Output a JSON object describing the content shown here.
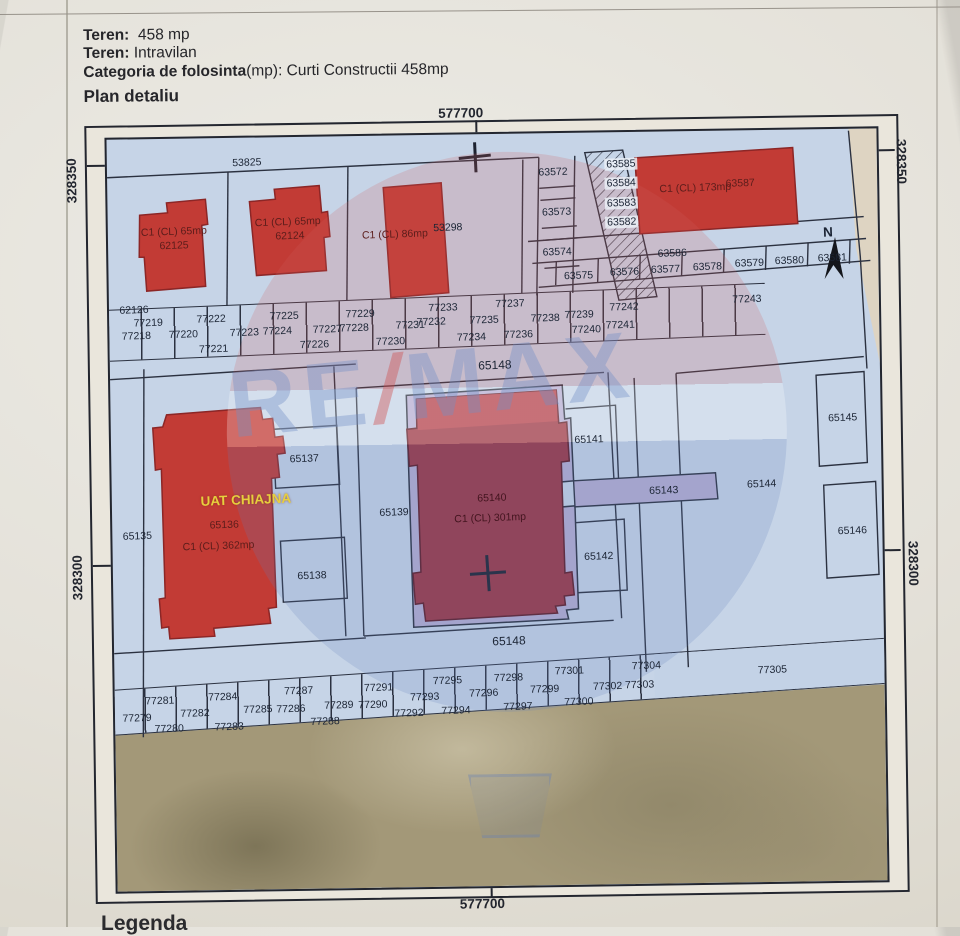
{
  "header": {
    "teren_label": "Teren:",
    "teren_value": "458 mp",
    "teren2_label": "Teren:",
    "teren2_value": "Intravilan",
    "categoria_label": "Categoria de folosinta",
    "categoria_value": "(mp): Curti Constructii 458mp",
    "plan_title": "Plan detaliu",
    "legend_partial": "Legenda"
  },
  "coords": {
    "top": "577700",
    "bottom": "577700",
    "left_top": "328350",
    "left_bottom": "328300",
    "right_top": "328350",
    "right_bottom": "328300"
  },
  "watermark": {
    "re": "RE",
    "slash": "/",
    "max": "MAX"
  },
  "colors": {
    "building_red": "#c23b35",
    "building_maroon": "#9c3744",
    "map_blue": "#c6d4e7",
    "lot_lavender": "#b5aed2",
    "uat_yellow": "#e7cf3d",
    "terrain_tan": "#a39878",
    "line": "#2b3140"
  },
  "map": {
    "parcel_labels": [
      {
        "t": "53825",
        "x": 140,
        "y": 25
      },
      {
        "t": "C1 (CL) 65mp",
        "x": 66,
        "y": 93,
        "c": "bld"
      },
      {
        "t": "62125",
        "x": 66,
        "y": 107,
        "c": "bld"
      },
      {
        "t": "C1 (CL) 65mp",
        "x": 180,
        "y": 85,
        "c": "bld"
      },
      {
        "t": "62124",
        "x": 182,
        "y": 99,
        "c": "bld"
      },
      {
        "t": "C1 (CL) 86mp",
        "x": 287,
        "y": 99,
        "c": "bld"
      },
      {
        "t": "53298",
        "x": 340,
        "y": 93
      },
      {
        "t": "62126",
        "x": 25,
        "y": 171
      },
      {
        "t": "63572",
        "x": 446,
        "y": 39
      },
      {
        "t": "63573",
        "x": 449,
        "y": 79
      },
      {
        "t": "63574",
        "x": 449,
        "y": 119
      },
      {
        "t": "63585",
        "x": 514,
        "y": 32,
        "c": "chip"
      },
      {
        "t": "63584",
        "x": 514,
        "y": 51,
        "c": "chip"
      },
      {
        "t": "63583",
        "x": 514,
        "y": 71,
        "c": "chip"
      },
      {
        "t": "63582",
        "x": 514,
        "y": 90,
        "c": "chip"
      },
      {
        "t": "C1 (CL) 173mp",
        "x": 588,
        "y": 57,
        "c": "bld"
      },
      {
        "t": "63587",
        "x": 633,
        "y": 53,
        "c": "bld"
      },
      {
        "t": "63586",
        "x": 564,
        "y": 122
      },
      {
        "t": "63575",
        "x": 470,
        "y": 143
      },
      {
        "t": "63576",
        "x": 516,
        "y": 140
      },
      {
        "t": "63577",
        "x": 557,
        "y": 138
      },
      {
        "t": "63578",
        "x": 599,
        "y": 136
      },
      {
        "t": "63579",
        "x": 641,
        "y": 133
      },
      {
        "t": "63580",
        "x": 681,
        "y": 131
      },
      {
        "t": "63581",
        "x": 724,
        "y": 129
      },
      {
        "t": "N",
        "x": 720,
        "y": 103,
        "c": "north"
      },
      {
        "t": "77243",
        "x": 638,
        "y": 169
      },
      {
        "t": "77218",
        "x": 27,
        "y": 197
      },
      {
        "t": "77219",
        "x": 39,
        "y": 184
      },
      {
        "t": "77220",
        "x": 74,
        "y": 196
      },
      {
        "t": "77221",
        "x": 104,
        "y": 211
      },
      {
        "t": "77222",
        "x": 102,
        "y": 181
      },
      {
        "t": "77223",
        "x": 135,
        "y": 195
      },
      {
        "t": "77224",
        "x": 168,
        "y": 194
      },
      {
        "t": "77225",
        "x": 175,
        "y": 179
      },
      {
        "t": "77226",
        "x": 205,
        "y": 208
      },
      {
        "t": "77227",
        "x": 218,
        "y": 193
      },
      {
        "t": "77228",
        "x": 245,
        "y": 192
      },
      {
        "t": "77229",
        "x": 251,
        "y": 178
      },
      {
        "t": "77230",
        "x": 281,
        "y": 206
      },
      {
        "t": "77231",
        "x": 301,
        "y": 190
      },
      {
        "t": "77232",
        "x": 322,
        "y": 187
      },
      {
        "t": "77233",
        "x": 334,
        "y": 173
      },
      {
        "t": "77234",
        "x": 362,
        "y": 203
      },
      {
        "t": "77235",
        "x": 375,
        "y": 186
      },
      {
        "t": "77236",
        "x": 409,
        "y": 201
      },
      {
        "t": "77237",
        "x": 401,
        "y": 170
      },
      {
        "t": "77238",
        "x": 436,
        "y": 185
      },
      {
        "t": "77239",
        "x": 470,
        "y": 182
      },
      {
        "t": "77240",
        "x": 477,
        "y": 197
      },
      {
        "t": "77241",
        "x": 511,
        "y": 193
      },
      {
        "t": "77242",
        "x": 515,
        "y": 175
      },
      {
        "t": "65148",
        "x": 385,
        "y": 231,
        "c": "road"
      },
      {
        "t": "65135",
        "x": 25,
        "y": 397
      },
      {
        "t": "UAT CHIAJNA",
        "x": 134,
        "y": 362,
        "c": "uat"
      },
      {
        "t": "65136",
        "x": 112,
        "y": 387,
        "c": "bld"
      },
      {
        "t": "C1 (CL) 362mp",
        "x": 106,
        "y": 408,
        "c": "bld"
      },
      {
        "t": "65137",
        "x": 193,
        "y": 322
      },
      {
        "t": "65138",
        "x": 199,
        "y": 439
      },
      {
        "t": "65139",
        "x": 282,
        "y": 377
      },
      {
        "t": "65140",
        "x": 380,
        "y": 364,
        "c": "bld2"
      },
      {
        "t": "C1 (CL) 301mp",
        "x": 378,
        "y": 384,
        "c": "bld2"
      },
      {
        "t": "65141",
        "x": 478,
        "y": 307
      },
      {
        "t": "65142",
        "x": 486,
        "y": 424
      },
      {
        "t": "65143",
        "x": 552,
        "y": 359
      },
      {
        "t": "65144",
        "x": 650,
        "y": 354
      },
      {
        "t": "65145",
        "x": 732,
        "y": 289
      },
      {
        "t": "65146",
        "x": 740,
        "y": 402
      },
      {
        "t": "65148",
        "x": 395,
        "y": 507,
        "c": "road"
      },
      {
        "t": "77279",
        "x": 22,
        "y": 579
      },
      {
        "t": "77280",
        "x": 54,
        "y": 590
      },
      {
        "t": "77281",
        "x": 45,
        "y": 562
      },
      {
        "t": "77282",
        "x": 80,
        "y": 575
      },
      {
        "t": "77283",
        "x": 114,
        "y": 589
      },
      {
        "t": "77284",
        "x": 108,
        "y": 559
      },
      {
        "t": "77285",
        "x": 143,
        "y": 572
      },
      {
        "t": "77286",
        "x": 176,
        "y": 572
      },
      {
        "t": "77287",
        "x": 184,
        "y": 554
      },
      {
        "t": "77288",
        "x": 210,
        "y": 585
      },
      {
        "t": "77289",
        "x": 224,
        "y": 569
      },
      {
        "t": "77290",
        "x": 258,
        "y": 569
      },
      {
        "t": "77291",
        "x": 264,
        "y": 552
      },
      {
        "t": "77292",
        "x": 294,
        "y": 578
      },
      {
        "t": "77293",
        "x": 310,
        "y": 562
      },
      {
        "t": "77294",
        "x": 341,
        "y": 576
      },
      {
        "t": "77295",
        "x": 333,
        "y": 546
      },
      {
        "t": "77296",
        "x": 369,
        "y": 559
      },
      {
        "t": "77297",
        "x": 403,
        "y": 573
      },
      {
        "t": "77298",
        "x": 394,
        "y": 544
      },
      {
        "t": "77299",
        "x": 430,
        "y": 556
      },
      {
        "t": "77300",
        "x": 464,
        "y": 569
      },
      {
        "t": "77301",
        "x": 455,
        "y": 538
      },
      {
        "t": "77302",
        "x": 493,
        "y": 554
      },
      {
        "t": "77303",
        "x": 525,
        "y": 553
      },
      {
        "t": "77304",
        "x": 532,
        "y": 534
      },
      {
        "t": "77305",
        "x": 658,
        "y": 540
      }
    ]
  }
}
